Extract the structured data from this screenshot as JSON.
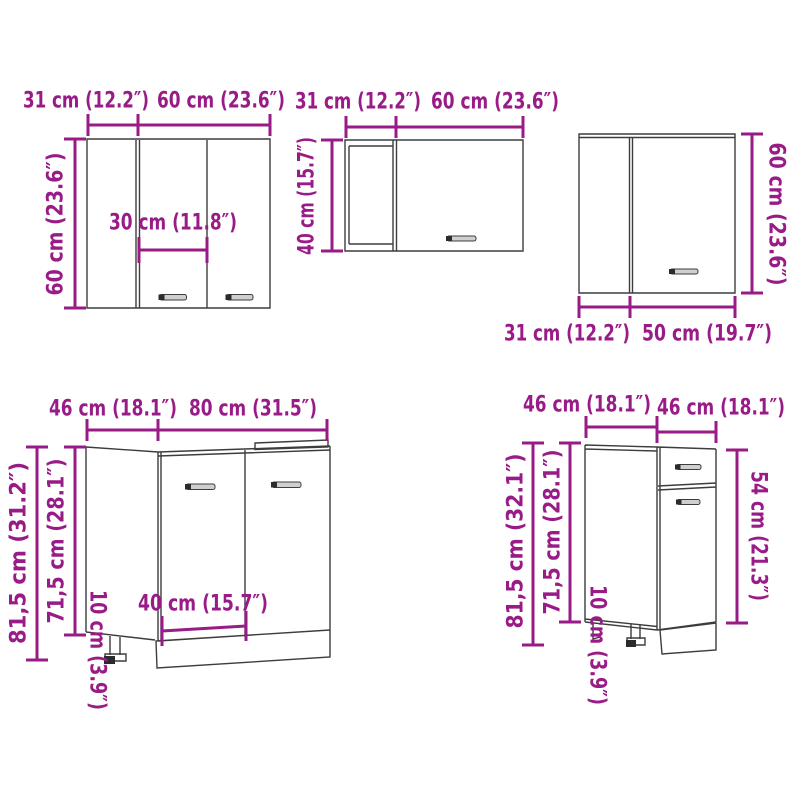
{
  "diagram_title": "kitchen cabinet set dimension diagram",
  "colors": {
    "dimension": "#991b87",
    "cabinet_line": "#3d3d3d",
    "background": "#ffffff",
    "handle_fill": "#cfcfcf",
    "handle_cap": "#2b2b2b"
  },
  "cabinets": {
    "wall_cabinet_left": {
      "depth_label": "31 cm (12.2″)",
      "width_label": "60 cm (23.6″)",
      "height_label": "60 cm (23.6″)",
      "inner_width_label": "30 cm (11.8″)"
    },
    "wall_cabinet_middle": {
      "depth_label": "31 cm (12.2″)",
      "width_label": "60 cm (23.6″)",
      "height_label": "40 cm (15.7″)"
    },
    "wall_cabinet_corner": {
      "height_label": "60 cm (23.6″)",
      "depth_label": "31 cm (12.2″)",
      "width_label": "50 cm (19.7″)"
    },
    "base_cabinet_sink": {
      "depth_label": "46 cm (18.1″)",
      "width_label": "80 cm (31.5″)",
      "total_height_label": "81,5 cm (31.2″)",
      "body_height_label": "71,5 cm (28.1″)",
      "plinth_height_label": "10 cm (3.9″)",
      "inner_width_label": "40 cm (15.7″)"
    },
    "base_cabinet_drawer": {
      "depth_label": "46 cm (18.1″)",
      "width_label": "46 cm (18.1″)",
      "total_height_label": "81,5 cm (32.1″)",
      "body_height_label": "71,5 cm (28.1″)",
      "plinth_height_label": "10 cm (3.9″)",
      "front_height_label": "54 cm (21.3″)"
    }
  }
}
